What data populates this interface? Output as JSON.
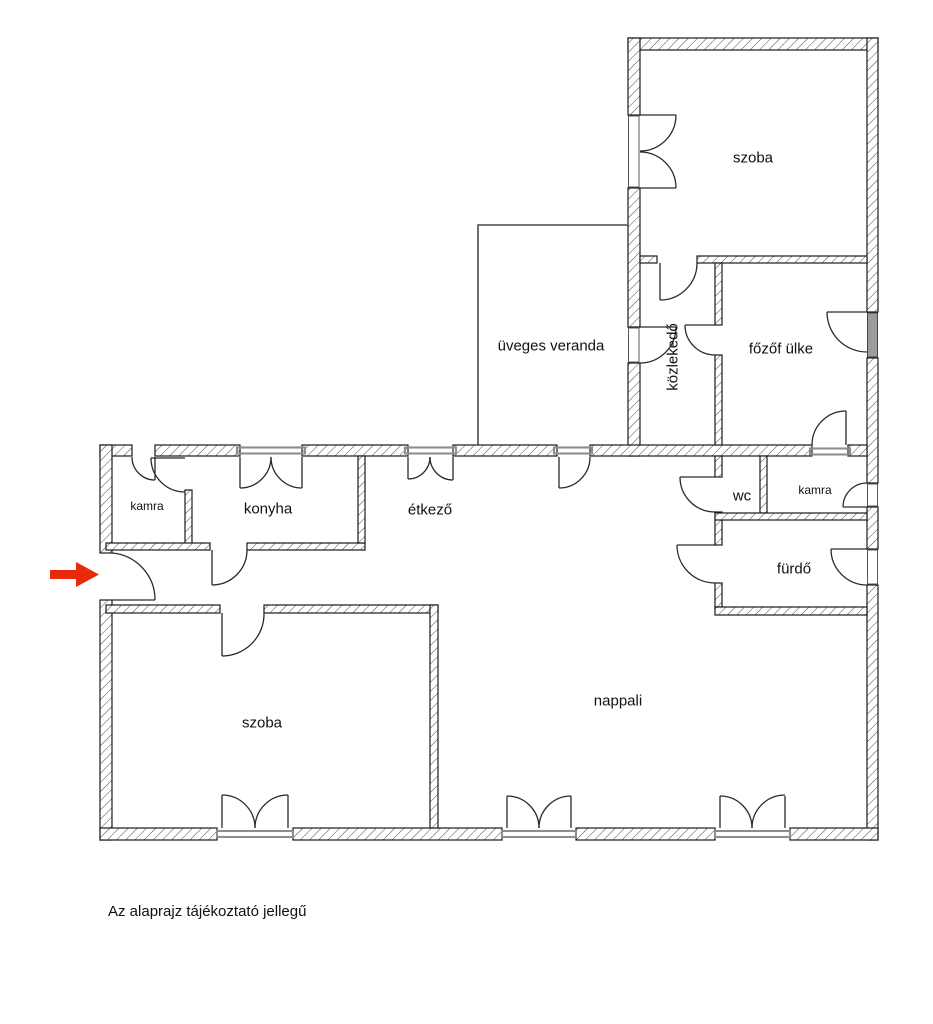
{
  "rooms": {
    "szoba_top": {
      "label": "szoba"
    },
    "uveges_veranda": {
      "label": "üveges veranda"
    },
    "kozlekedo": {
      "label": "közlekedő"
    },
    "fozofulke": {
      "label": "főzőf ülke"
    },
    "kamra_left": {
      "label": "kamra"
    },
    "konyha": {
      "label": "konyha"
    },
    "etkezo": {
      "label": "étkező"
    },
    "wc": {
      "label": "wc"
    },
    "kamra_right": {
      "label": "kamra"
    },
    "furdo": {
      "label": "fürdő"
    },
    "szoba_bottom": {
      "label": "szoba"
    },
    "nappali": {
      "label": "nappali"
    }
  },
  "caption": {
    "text": "Az alaprajz tájékoztató jellegű"
  },
  "entrance_arrow": {
    "color": "#e8290c",
    "direction": "right"
  },
  "colors": {
    "background": "#ffffff",
    "wall_line": "#1a1a1a",
    "window_sill": "#8e8e8e"
  }
}
